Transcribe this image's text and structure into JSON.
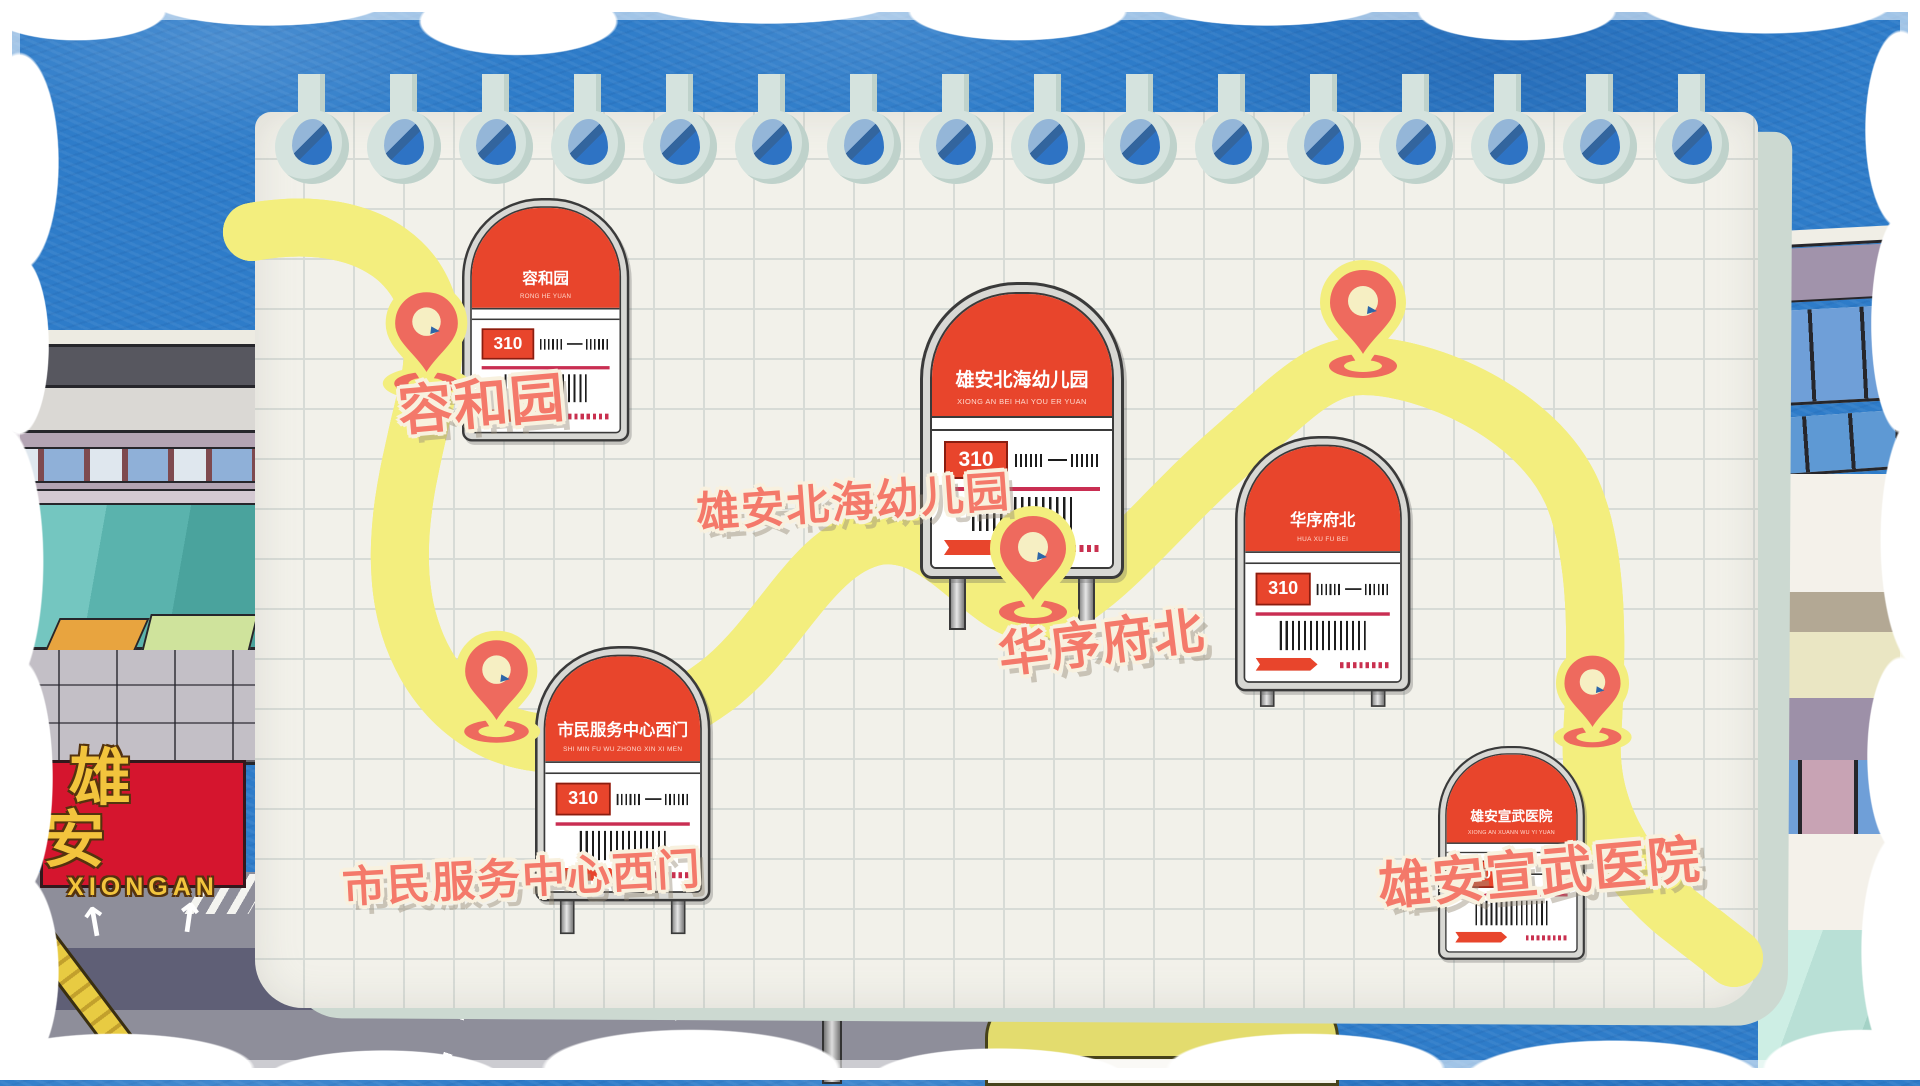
{
  "route_number": "310",
  "stops": [
    {
      "name": "容和园",
      "pinyin": "RONG HE YUAN",
      "route": "310"
    },
    {
      "name": "市民服务中心西门",
      "pinyin": "SHI MIN FU WU ZHONG XIN XI MEN",
      "route": "310"
    },
    {
      "name": "雄安北海幼儿园",
      "pinyin": "XIONG AN BEI HAI YOU ER YUAN",
      "route": "310"
    },
    {
      "name": "华序府北",
      "pinyin": "HUA XU FU BEI",
      "route": "310"
    },
    {
      "name": "雄安宣武医院",
      "pinyin": "XIONG AN XUANN WU YI YUAN",
      "route": "310"
    }
  ],
  "billboard": {
    "cn": "雄安",
    "en": "XIONGAN"
  },
  "icons": {
    "pin": "location-pin",
    "holes": "binder-hole",
    "arrow": "direction-arrow"
  },
  "colors": {
    "sky": "#2e7cc9",
    "paper": "#f2f1ea",
    "route_blue": "#2e7fc4",
    "route_outline": "#f3ee7e",
    "pin_coral": "#ee6a5e",
    "sign_red": "#e8452c",
    "label_coral": "#f4796a",
    "billboard_red": "#d5152e",
    "billboard_gold": "#f2c43d"
  }
}
